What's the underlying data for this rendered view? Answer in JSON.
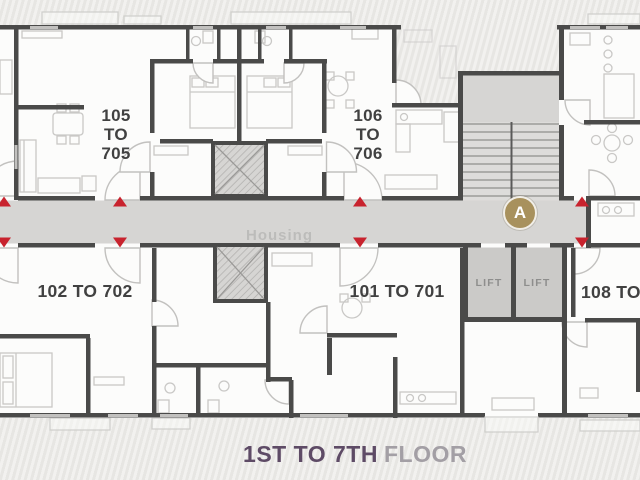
{
  "caption": {
    "range": "1ST TO 7TH",
    "word": "FLOOR"
  },
  "badge": {
    "label": "A"
  },
  "watermark": {
    "text": "Housing"
  },
  "units": {
    "u105": {
      "lines": [
        "105",
        "TO",
        "705"
      ]
    },
    "u106": {
      "lines": [
        "106",
        "TO",
        "706"
      ]
    },
    "u102": {
      "label": "102 TO 702"
    },
    "u101": {
      "label": "101 TO 701"
    },
    "u108": {
      "label": "108 TO"
    }
  },
  "lifts": {
    "left": "LIFT",
    "right": "LIFT"
  },
  "colors": {
    "wall": "#4a4a49",
    "corridor": "#d6d5d3",
    "entry_marker": "#c8232e",
    "badge_fill": "#a8915d",
    "caption_range": "#5e4b66",
    "caption_word": "#a39fa5",
    "unit_label": "#414141",
    "lift_label": "#8e8e8d"
  }
}
